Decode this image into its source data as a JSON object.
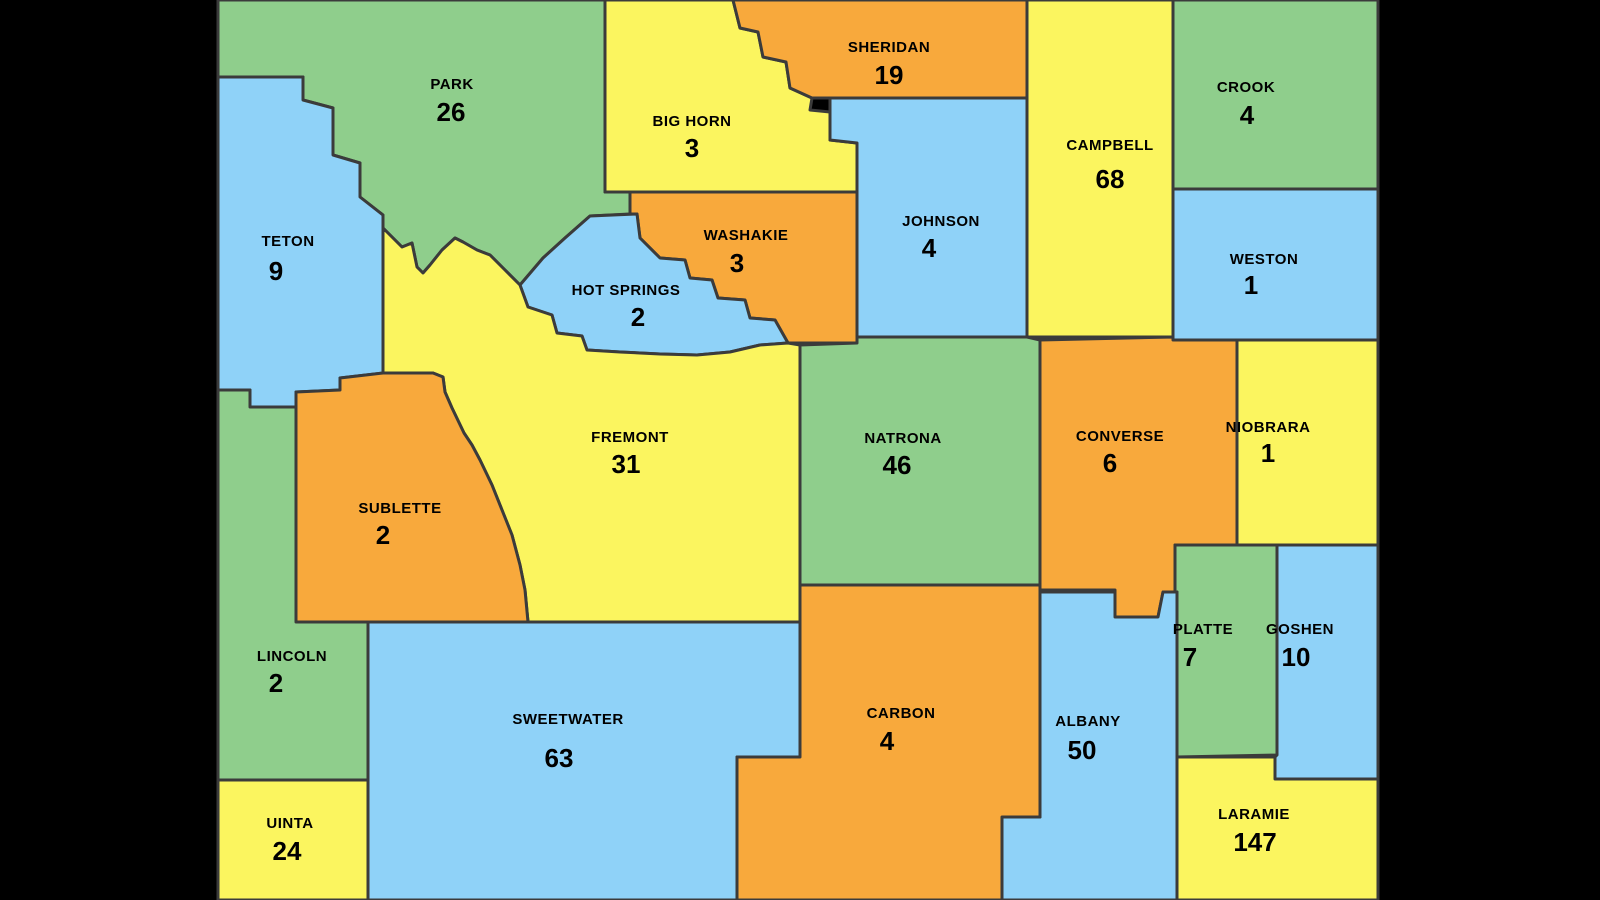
{
  "map": {
    "title": "Wyoming county map with values"
  },
  "colors": {
    "green": "#8FCE8C",
    "yellow": "#FBF55F",
    "orange": "#F8A93C",
    "blue": "#8FD2F8",
    "border": "#3B3B3B",
    "background": "#000000",
    "label": "#000000"
  },
  "counties": [
    {
      "name": "PARK",
      "value": "26",
      "color": "green"
    },
    {
      "name": "BIG HORN",
      "value": "3",
      "color": "yellow"
    },
    {
      "name": "SHERIDAN",
      "value": "19",
      "color": "orange"
    },
    {
      "name": "CAMPBELL",
      "value": "68",
      "color": "yellow"
    },
    {
      "name": "CROOK",
      "value": "4",
      "color": "green"
    },
    {
      "name": "TETON",
      "value": "9",
      "color": "blue"
    },
    {
      "name": "WASHAKIE",
      "value": "3",
      "color": "orange"
    },
    {
      "name": "JOHNSON",
      "value": "4",
      "color": "blue"
    },
    {
      "name": "WESTON",
      "value": "1",
      "color": "blue"
    },
    {
      "name": "HOT SPRINGS",
      "value": "2",
      "color": "blue"
    },
    {
      "name": "FREMONT",
      "value": "31",
      "color": "yellow"
    },
    {
      "name": "NATRONA",
      "value": "46",
      "color": "green"
    },
    {
      "name": "CONVERSE",
      "value": "6",
      "color": "orange"
    },
    {
      "name": "NIOBRARA",
      "value": "1",
      "color": "yellow"
    },
    {
      "name": "SUBLETTE",
      "value": "2",
      "color": "orange"
    },
    {
      "name": "LINCOLN",
      "value": "2",
      "color": "green"
    },
    {
      "name": "UINTA",
      "value": "24",
      "color": "yellow"
    },
    {
      "name": "SWEETWATER",
      "value": "63",
      "color": "blue"
    },
    {
      "name": "NATRONA-DUP-UNUSED",
      "value": "",
      "color": "green"
    },
    {
      "name": "CARBON",
      "value": "4",
      "color": "orange"
    },
    {
      "name": "ALBANY",
      "value": "50",
      "color": "blue"
    },
    {
      "name": "PLATTE",
      "value": "7",
      "color": "green"
    },
    {
      "name": "GOSHEN",
      "value": "10",
      "color": "blue"
    },
    {
      "name": "LARAMIE",
      "value": "147",
      "color": "yellow"
    }
  ]
}
